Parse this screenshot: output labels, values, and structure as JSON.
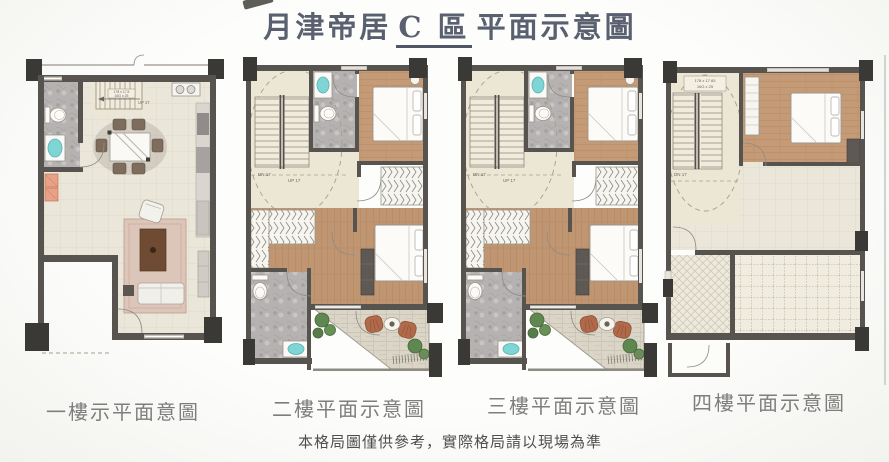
{
  "title": {
    "pre": "月津帝居",
    "highlight": "C 區",
    "post": "平面示意圖"
  },
  "floors": [
    {
      "label": "一樓示平面意圖",
      "stair_up": "UP 17",
      "stair_dim1": "178 x 17.5",
      "stair_dim2": "16G x 25"
    },
    {
      "label": "二樓平面示意圖",
      "stair_up": "UP 17",
      "stair_dn": "DN 17"
    },
    {
      "label": "三樓平面示意圖",
      "stair_up": "UP 17",
      "stair_dn": "DN 17"
    },
    {
      "label": "四樓平面示意圖",
      "stair_dn": "DN 17",
      "stair_dim1": "178 x 17.65",
      "stair_dim2": "16G x 25"
    }
  ],
  "note": "本格局圖僅供參考，實際格局請以現場為準",
  "colors": {
    "title_ink": "#59606f",
    "caption_gray": "#7e7e7e",
    "wall": "#57534e",
    "column": "#3b3936",
    "wood": "#c59b77",
    "tile": "#eae6d9",
    "stair_cream": "#ece7d5",
    "bath_gray": "#b6b2b1",
    "sink_cyan": "#7fd4d4",
    "cabinet_orange": "#e8a184",
    "rug_pink": "#dcc5b9",
    "terracotta": "#b06a4a",
    "plant_green": "#5f8750"
  }
}
